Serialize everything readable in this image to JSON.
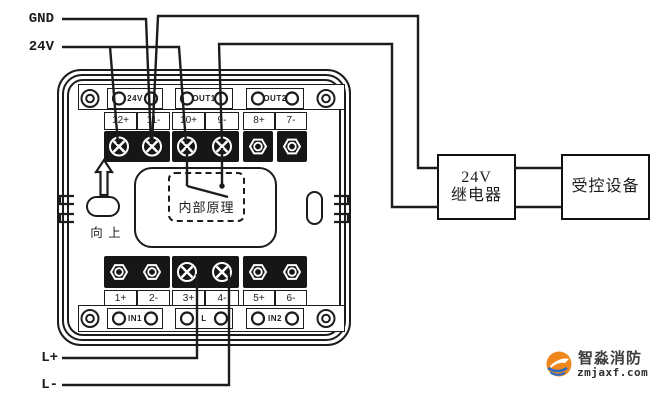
{
  "diagram": {
    "power_labels": {
      "gnd": "GND",
      "v24": "24V"
    },
    "loop_labels": {
      "l_plus": "L+",
      "l_minus": "L-"
    },
    "module": {
      "top_strip": [
        "24V",
        "OUT1",
        "OUT2"
      ],
      "top_terminals": [
        "12+",
        "11-",
        "10+",
        "9-",
        "8+",
        "7-"
      ],
      "bottom_terminals": [
        "1+",
        "2-",
        "3+",
        "4-",
        "5+",
        "6-"
      ],
      "bottom_strip": [
        "IN1",
        "L",
        "IN2"
      ],
      "internal_box_label": "内部原理",
      "orientation_label": "向 上"
    },
    "relay_box": {
      "line1": "24V",
      "line2": "继电器"
    },
    "device_box": {
      "label": "受控设备"
    },
    "colors": {
      "line": "#1c1c1c"
    }
  },
  "logo": {
    "brand": "智淼消防",
    "domain": "zmjaxf.com",
    "accent_orange": "#f0871d",
    "accent_blue": "#2e6cc0",
    "text_color": "#3d3d3d"
  }
}
